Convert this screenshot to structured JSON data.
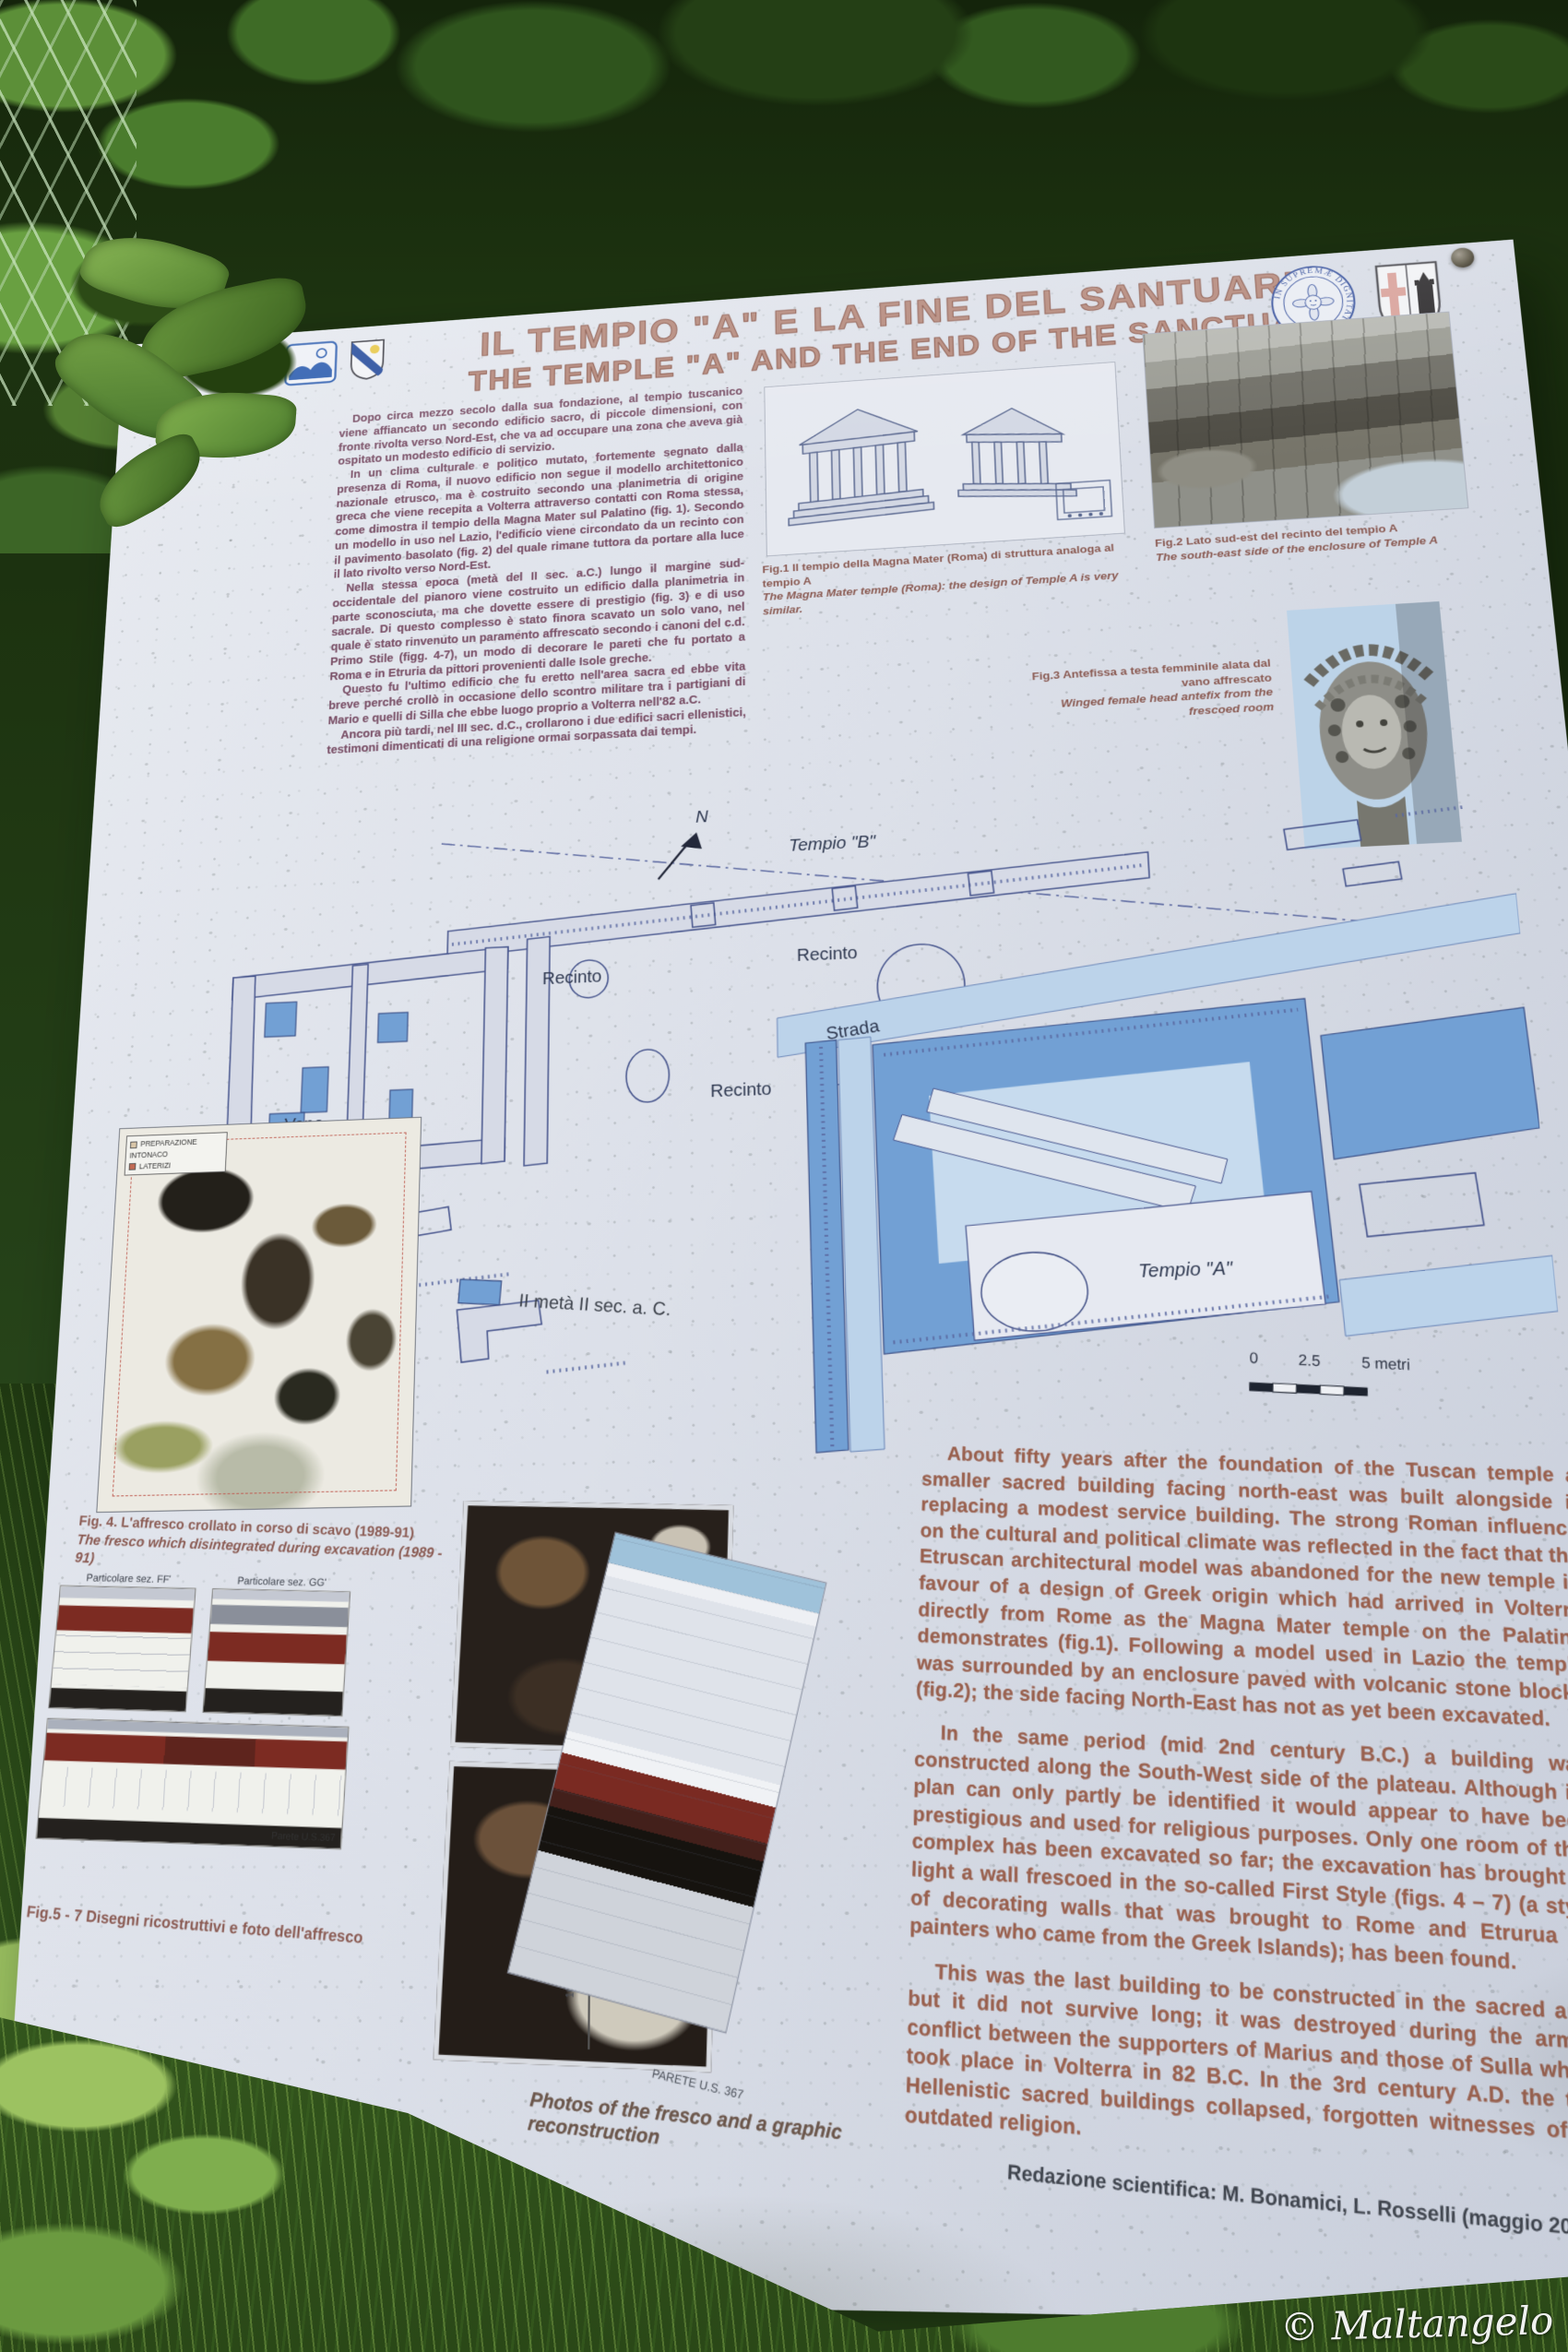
{
  "photo": {
    "watermark": "© Maltangelo"
  },
  "sign": {
    "title_it": "IL TEMPIO \"A\"  E LA FINE DEL SANTUARIO",
    "title_en": "THE TEMPLE \"A\" AND THE END OF THE SANCTUARY",
    "intro_it": {
      "p1": "Dopo circa mezzo secolo dalla sua fondazione, al tempio tuscanico viene affiancato un secondo edificio sacro, di piccole dimensioni, con fronte rivolta verso Nord-Est, che va ad occupare una zona che aveva già ospitato un modesto edificio di servizio.",
      "p2": "In un clima culturale e politico mutato, fortemente segnato dalla presenza di Roma, il nuovo edificio non segue il modello architettonico nazionale etrusco, ma è costruito secondo una planimetria di origine greca che viene recepita a Volterra attraverso contatti con Roma stessa, come dimostra il tempio della Magna Mater sul Palatino (fig. 1). Secondo un modello in uso nel Lazio, l'edificio viene circondato da un recinto con il pavimento basolato (fig. 2) del quale rimane tuttora da portare alla luce il lato rivolto verso Nord-Est.",
      "p3": "Nella stessa epoca (metà del II sec. a.C.) lungo il margine sud-occidentale del pianoro viene costruito un edificio dalla planimetria in parte sconosciuta, ma che dovette essere di prestigio (fig. 3) e di uso sacrale. Di questo complesso è stato finora scavato un solo vano, nel quale è stato rinvenuto un paramento affrescato secondo i canoni del c.d. Primo Stile (figg. 4-7), un modo di decorare le pareti che fu portato a Roma e in Etruria da pittori provenienti dalle Isole greche.",
      "p4": "Questo fu l'ultimo edificio che fu eretto nell'area sacra ed ebbe vita breve perché crollò in occasione dello scontro militare tra i partigiani di Mario e quelli di Silla che ebbe luogo proprio a Volterra nell'82 a.C.",
      "p5": "Ancora più tardi, nel III sec. d.C., crollarono i due edifici sacri ellenistici, testimoni dimenticati di una religione ormai sorpassata dai tempi."
    },
    "english": {
      "p1": "About fifty years after the foundation of the Tuscan temple a smaller sacred building facing north-east was built alongside it replacing a modest service building. The strong Roman influence on the cultural and political climate was reflected in the fact that the Etruscan architectural model was abandoned for the new temple in favour of a design of Greek origin which had arrived in Volterra directly from Rome as the Magna Mater temple on the Palatine demonstrates (fig.1). Following a model used in Lazio the temple was surrounded by an enclosure paved with volcanic stone blocks (fig.2); the side facing North-East has not as yet been excavated.",
      "p2": "In the same period (mid 2nd century B.C.) a building was constructed along the South-West side of the plateau. Although its plan can only partly be identified it would appear to have been prestigious and used for religious purposes. Only one room of this complex has been excavated so far; the excavation has brought to light a wall frescoed in the so-called First Style (figs. 4 – 7) (a style of decorating walls that was brought to Rome and Etrurua by painters who came from the Greek Islands); has been found.",
      "p3": "This was the last building to be constructed in the sacred area but it did not survive long; it was destroyed during the armed conflict between the supporters of Marius and those of Sulla which took place in Volterra in 82 B.C. In the 3rd century A.D. the two Hellenistic sacred buildings collapsed, forgotten witnesses of an outdated religion."
    },
    "credits": "Redazione scientifica: M. Bonamici, L. Rosselli (maggio 2007)"
  },
  "figures": {
    "fig1": {
      "caption_it": "Fig.1 Il tempio della Magna Mater (Roma) di struttura analoga al tempio A",
      "caption_en": "The Magna Mater temple (Roma): the design of Temple A is very similar."
    },
    "fig2": {
      "caption_it": "Fig.2 Lato sud-est del recinto del tempio A",
      "caption_en": "The south-east side of the enclosure of Temple A"
    },
    "fig3": {
      "caption_it": "Fig.3 Antefissa a testa femminile alata dal vano affrescato",
      "caption_en": "Winged female head antefix from the frescoed room"
    },
    "fig4": {
      "caption_it": "Fig. 4. L'affresco crollato in corso di scavo (1989-91)",
      "caption_en": "The fresco which disintegrated during excavation (1989 - 91)",
      "key_line1": "PREPARAZIONE INTONACO",
      "key_line2": "LATERIZI"
    },
    "fig57": {
      "caption_it": "Fig.5 - 7 Disegni ricostruttivi e foto dell'affresco"
    },
    "photos": {
      "caption_en": "Photos of the fresco  and a graphic reconstruction"
    },
    "sections": {
      "left": "Particolare sez. FF'",
      "right": "Particolare sez. GG'",
      "wall": "Parete U.S.367",
      "wall_big": "PARETE U.S. 367",
      "ruler": "100 cm"
    }
  },
  "map": {
    "north": "N",
    "tempio_b": "Tempio \"B\"",
    "recinto": "Recinto",
    "strada": "Strada",
    "vano_line1": "Vano",
    "vano_line2": "affrescato",
    "tempio_a": "Tempio \"A\"",
    "legend_label": "II metà II sec. a. C.",
    "legend_color": "#72a0d4",
    "scale_0": "0",
    "scale_25": "2.5",
    "scale_5": "5 metri"
  },
  "logos": {
    "pisa_motto": "IN SUPREMÆ DIGNITATIS",
    "pisa_year": "1343"
  },
  "colors": {
    "map_fill": "#72a0d4",
    "map_fill_light": "#bcd3ea",
    "title": "#9b6a5c"
  }
}
